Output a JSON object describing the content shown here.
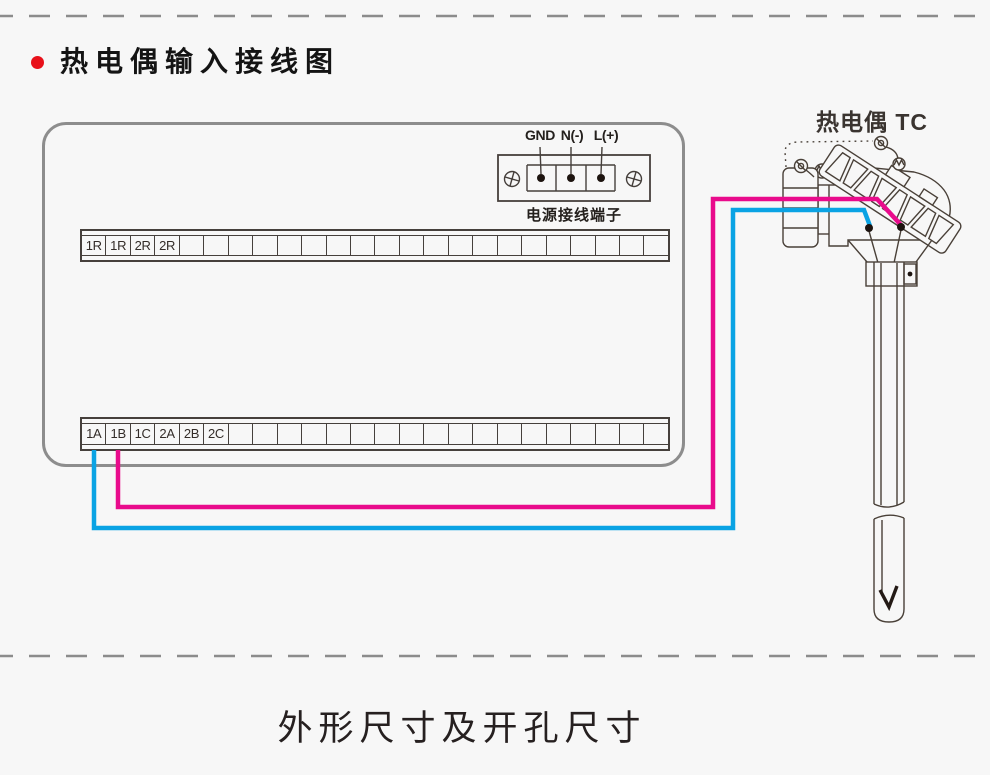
{
  "page": {
    "background": "#f7f7f7",
    "divider_color": "#8c8c8c"
  },
  "header": {
    "bullet_color": "#e8111a",
    "title": "热电偶输入接线图"
  },
  "panel": {
    "power_terminal": {
      "labels": [
        "GND",
        "N(-)",
        "L(+)"
      ],
      "caption": "电源接线端子"
    },
    "strip_top": {
      "cell_count": 24,
      "labels": [
        "1R",
        "1R",
        "2R",
        "2R"
      ]
    },
    "strip_bottom": {
      "cell_count": 24,
      "labels": [
        "1A",
        "1B",
        "1C",
        "2A",
        "2B",
        "2C"
      ]
    }
  },
  "thermocouple": {
    "label": "热电偶 TC"
  },
  "wires": {
    "negative": {
      "color": "#0aa3e4",
      "from_terminal": "1A"
    },
    "positive": {
      "color": "#e90b8c",
      "from_terminal": "1B"
    }
  },
  "footer": {
    "title": "外形尺寸及开孔尺寸"
  }
}
